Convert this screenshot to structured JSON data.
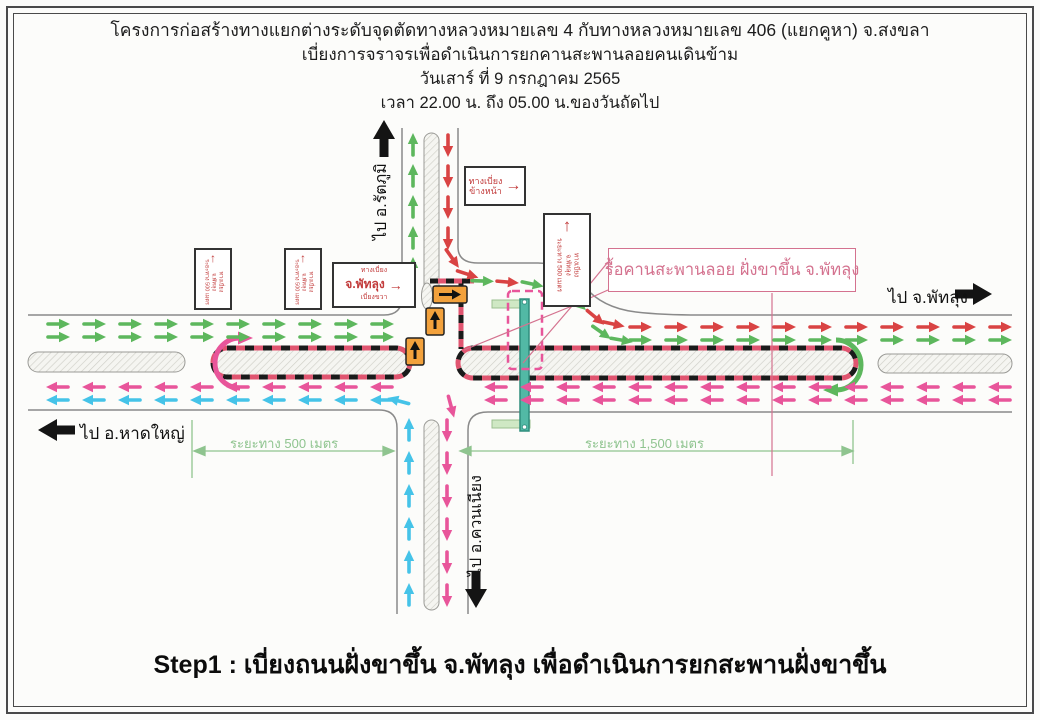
{
  "page": {
    "title_lines": [
      "โครงการก่อสร้างทางแยกต่างระดับจุดตัดทางหลวงหมายเลข 4 กับทางหลวงหมายเลข 406 (แยกคูหา) จ.สงขลา",
      "เบี่ยงการจราจรเพื่อดำเนินการยกคานสะพานลอยคนเดินข้าม",
      "วันเสาร์ ที่ 9 กรกฎาคม 2565",
      "เวลา 22.00 น. ถึง 05.00 น.ของวันถัดไป"
    ],
    "caption": "Step1 : เบี่ยงถนนฝั่งขาขึ้น จ.พัทลุง เพื่อดำเนินการยกสะพานฝั่งขาขึ้น"
  },
  "labels": {
    "north": "ไป อ.รัตภูมิ",
    "south": "ไป อ.ควนเนียง",
    "west": "ไป อ.หาดใหญ่",
    "east": "ไป จ.พัทลุง"
  },
  "callout": {
    "text": "รื้อคานสะพานลอย ฝั่งขาขึ้น จ.พัทลุง"
  },
  "dimensions": {
    "left": "ระยะทาง 500 เมตร",
    "right": "ระยะทาง 1,500 เมตร"
  },
  "signs": {
    "ahead": {
      "line1": "ทางเบี่ยง",
      "line2": "ข้างหน้า",
      "arrow": "→"
    },
    "divert": {
      "line1": "ทางเบี่ยง",
      "line2": "จ.พัทลุง",
      "line3": "เบี่ยงขวา",
      "arrow": "→"
    },
    "vertical": {
      "line1": "ทางเบี่ยง",
      "line2": "จ.พัทลุง",
      "line3": "ระยะทาง 500 เมตร",
      "arrow": "↑"
    }
  },
  "colors": {
    "green": "#5db75d",
    "red": "#d94343",
    "pink": "#e8559a",
    "cyan": "#45c3e8",
    "orange": "#f2a13c",
    "bridge": "#52b9a5",
    "bridge_edge": "#2e8d7d",
    "stair": "#cfe8c4",
    "dim": "#8fc48f",
    "callout": "#d4728f",
    "sign": "#c23b3b",
    "barrier_black": "#1a1a1a",
    "barrier_red": "#e05570",
    "road_edge": "#8a8a8a"
  }
}
